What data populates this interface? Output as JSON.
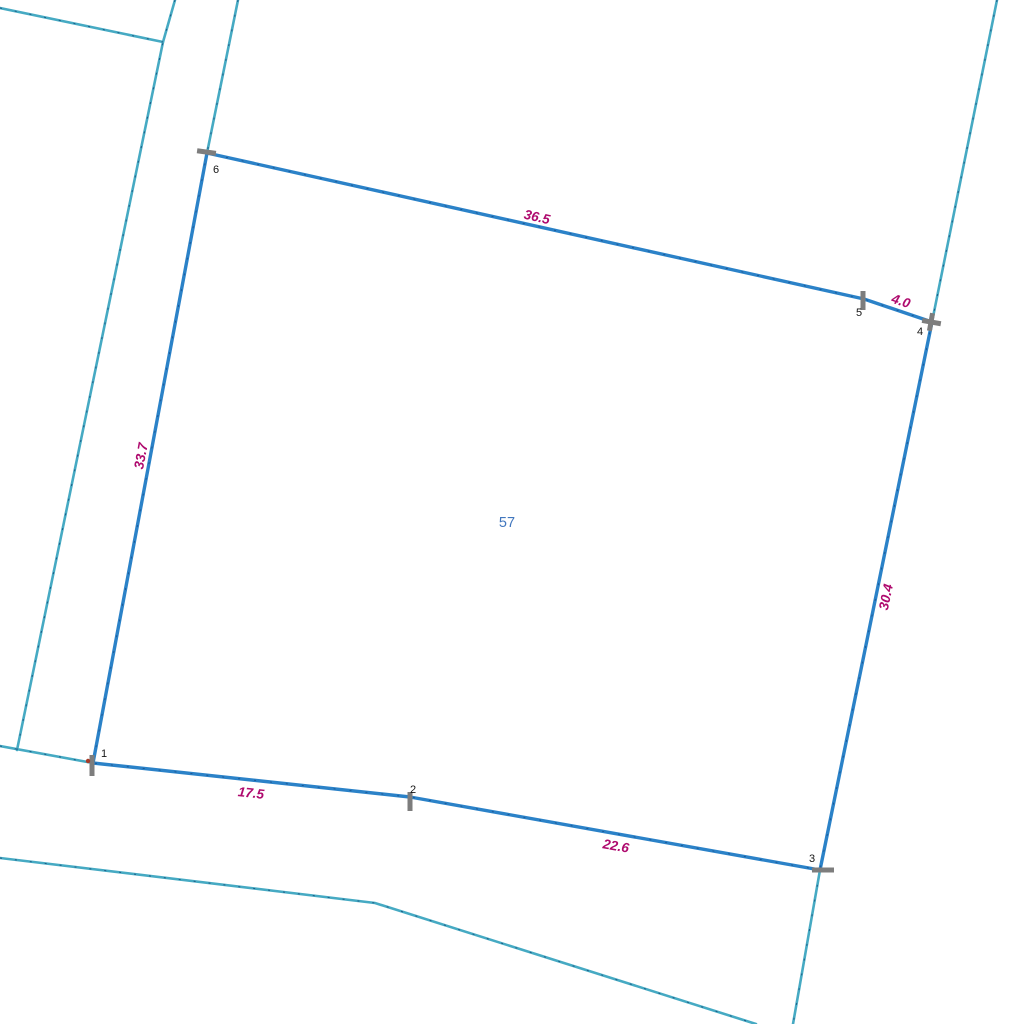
{
  "map": {
    "parcel": {
      "number": "57",
      "number_color": "#4277be"
    },
    "colors": {
      "parcel_boundary": "#2b82c8",
      "neighbor_line": "#46aac3",
      "dimension_label": "#af0a6e",
      "vertex_number": "#151515",
      "vertex_marker": "#7d7d7d",
      "boundary_point_dot": "#a83b28",
      "background": "#ffffff"
    },
    "vertices": [
      {
        "number": "1"
      },
      {
        "number": "2"
      },
      {
        "number": "3"
      },
      {
        "number": "4"
      },
      {
        "number": "5"
      },
      {
        "number": "6"
      }
    ],
    "edges": [
      {
        "from": "6",
        "to": "5",
        "length": "36.5"
      },
      {
        "from": "5",
        "to": "4",
        "length": "4.0"
      },
      {
        "from": "4",
        "to": "3",
        "length": "30.4"
      },
      {
        "from": "3",
        "to": "2",
        "length": "22.6"
      },
      {
        "from": "2",
        "to": "1",
        "length": "17.5"
      },
      {
        "from": "1",
        "to": "6",
        "length": "33.7"
      }
    ]
  }
}
